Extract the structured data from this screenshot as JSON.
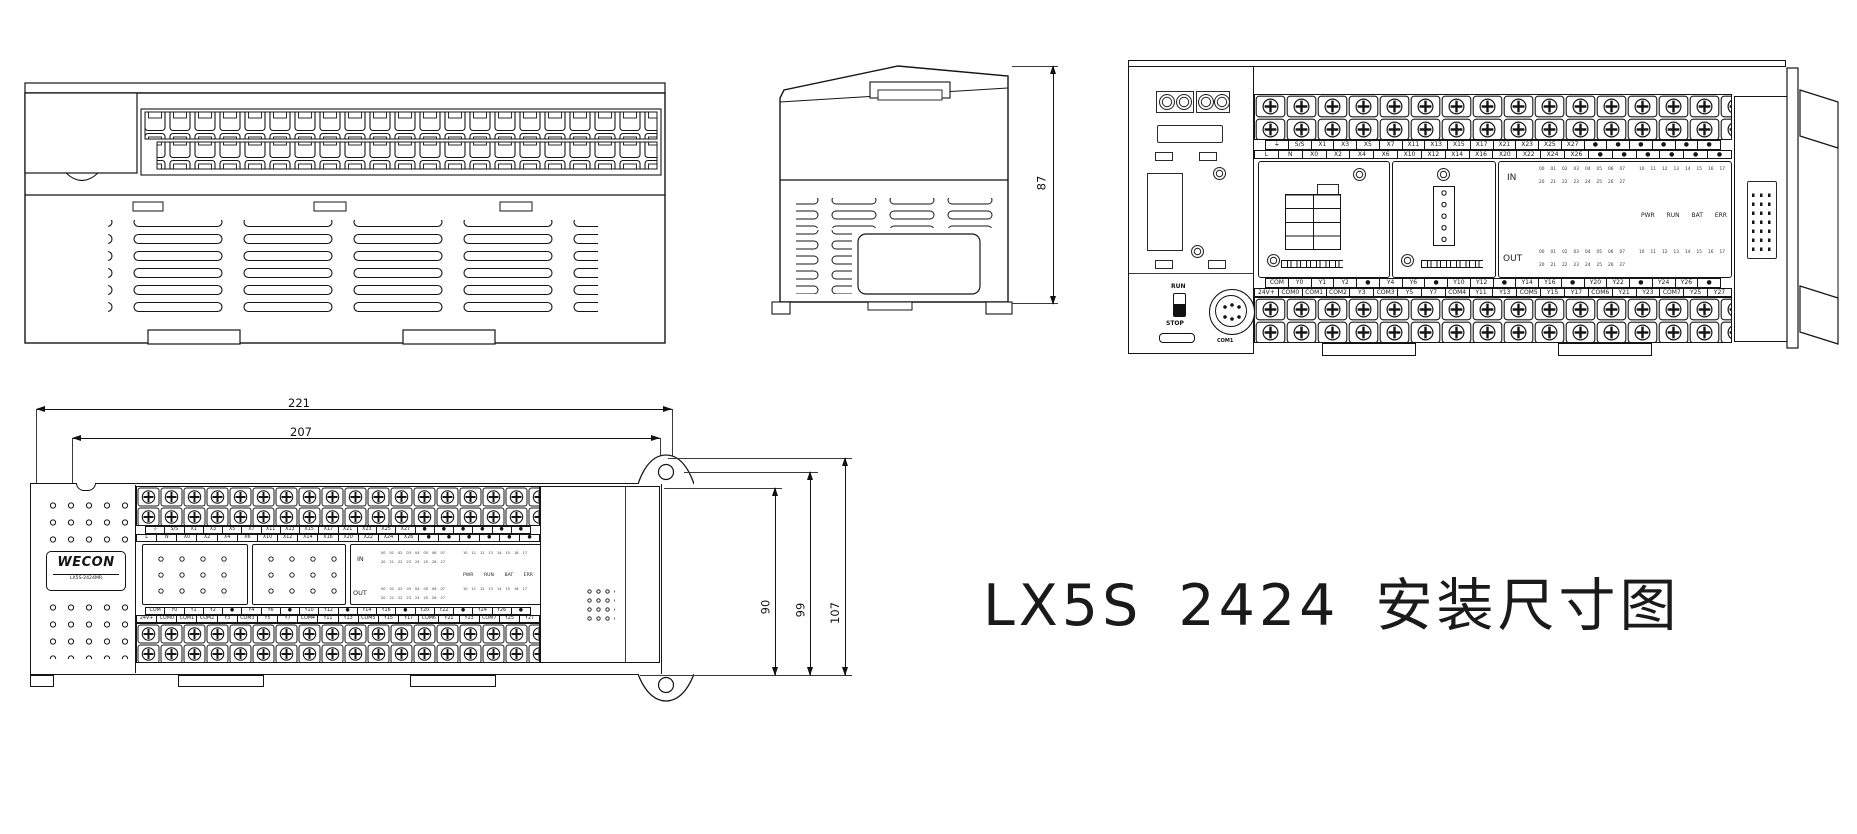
{
  "title": "LX5S 2424 安装尺寸图",
  "device": {
    "brand": "WECON",
    "model": "LX5S-2424MR"
  },
  "colors": {
    "ink": "#151515",
    "background": "#ffffff"
  },
  "controls": {
    "run": "RUN",
    "stop": "STOP",
    "com1": "COM1"
  },
  "panel": {
    "in": "IN",
    "out": "OUT",
    "led_row_a": [
      "00",
      "01",
      "02",
      "03",
      "04",
      "05",
      "06",
      "07"
    ],
    "led_row_b": [
      "10",
      "11",
      "12",
      "13",
      "14",
      "15",
      "16",
      "17"
    ],
    "led_row_c": [
      "20",
      "21",
      "22",
      "23",
      "24",
      "25",
      "26",
      "27"
    ],
    "status": [
      "PWR",
      "RUN",
      "BAT",
      "ERR"
    ]
  },
  "terminals": {
    "top_upper": [
      "⏚",
      "S/S",
      "X1",
      "X3",
      "X5",
      "X7",
      "X11",
      "X13",
      "X15",
      "X17",
      "X21",
      "X23",
      "X25",
      "X27",
      "●",
      "●",
      "●",
      "●",
      "●",
      "●"
    ],
    "top_lower": [
      "L",
      "N",
      "X0",
      "X2",
      "X4",
      "X6",
      "X10",
      "X12",
      "X14",
      "X16",
      "X20",
      "X22",
      "X24",
      "X26",
      "●",
      "●",
      "●",
      "●",
      "●",
      "●"
    ],
    "bottom_upper": [
      "COM",
      "Y0",
      "Y1",
      "Y2",
      "●",
      "Y4",
      "Y6",
      "●",
      "Y10",
      "Y12",
      "●",
      "Y14",
      "Y16",
      "●",
      "Y20",
      "Y22",
      "●",
      "Y24",
      "Y26",
      "●"
    ],
    "bottom_lower": [
      "24V+",
      "COM0",
      "COM1",
      "COM2",
      "Y3",
      "COM3",
      "Y5",
      "Y7",
      "COM4",
      "Y11",
      "Y13",
      "COM5",
      "Y15",
      "Y17",
      "COM6",
      "Y21",
      "Y23",
      "COM7",
      "Y25",
      "Y27"
    ]
  },
  "dimensions": {
    "overall_width": "221",
    "mounting_width": "207",
    "side_height": "87",
    "body_height": "90",
    "mounting_height": "99",
    "overall_height": "107"
  }
}
